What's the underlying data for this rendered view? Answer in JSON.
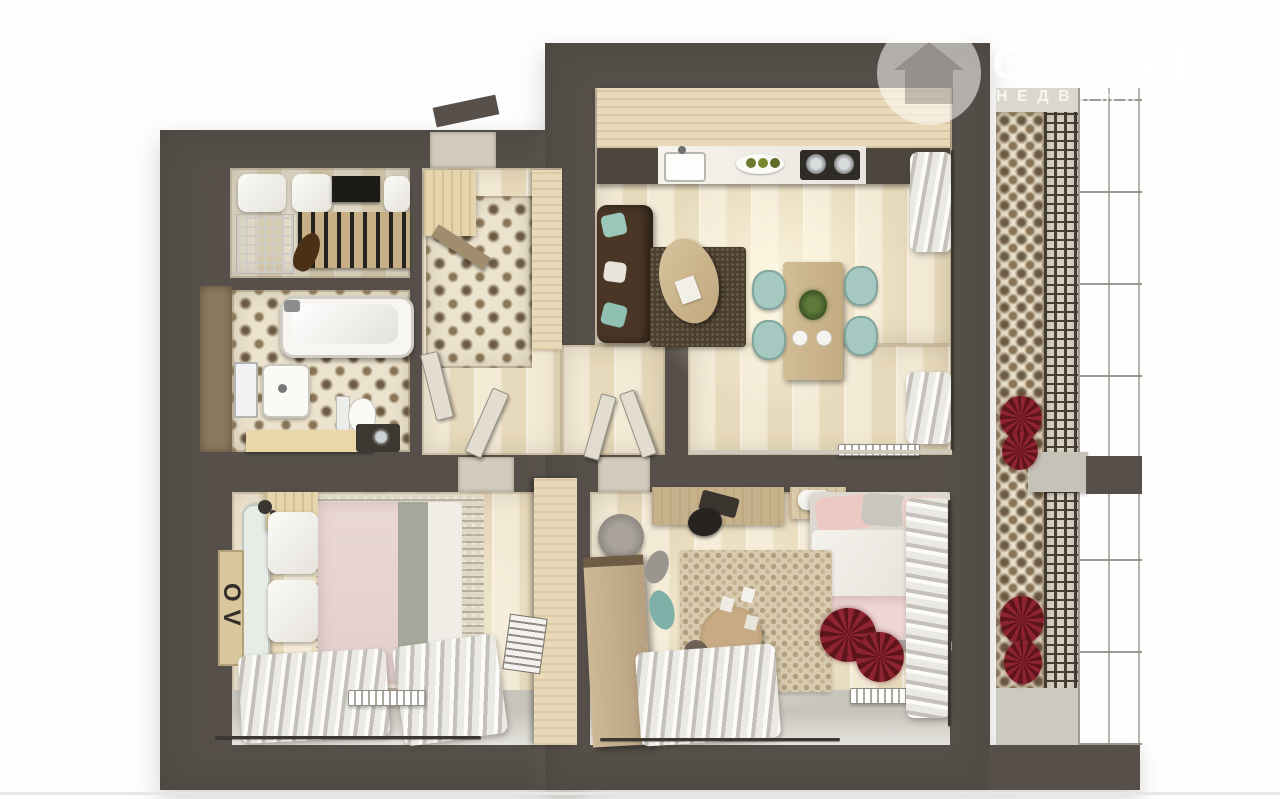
{
  "watermark": {
    "brand": "ONREALT",
    "tagline": "НЕДВИЖИМОСТЬ",
    "icon": "house-circle-icon"
  },
  "poster": {
    "text": "OV"
  },
  "scene": {
    "type": "apartment-floor-plan-3d-top-view",
    "rooms": [
      "walk-in-closet",
      "bathroom",
      "entrance-hall",
      "kitchen-living-room",
      "bedroom",
      "kids-bedroom",
      "balcony"
    ],
    "palette": {
      "wall": "#57504a",
      "wood_floor": "#efe4cb",
      "ornate_tile": "#ece3ce",
      "accent_teal": "#a5c9c1",
      "accent_pink": "#e7d5d3",
      "plant_red": "#8e2430",
      "sofa_brown": "#4a3627",
      "background": "#ffffff"
    }
  }
}
